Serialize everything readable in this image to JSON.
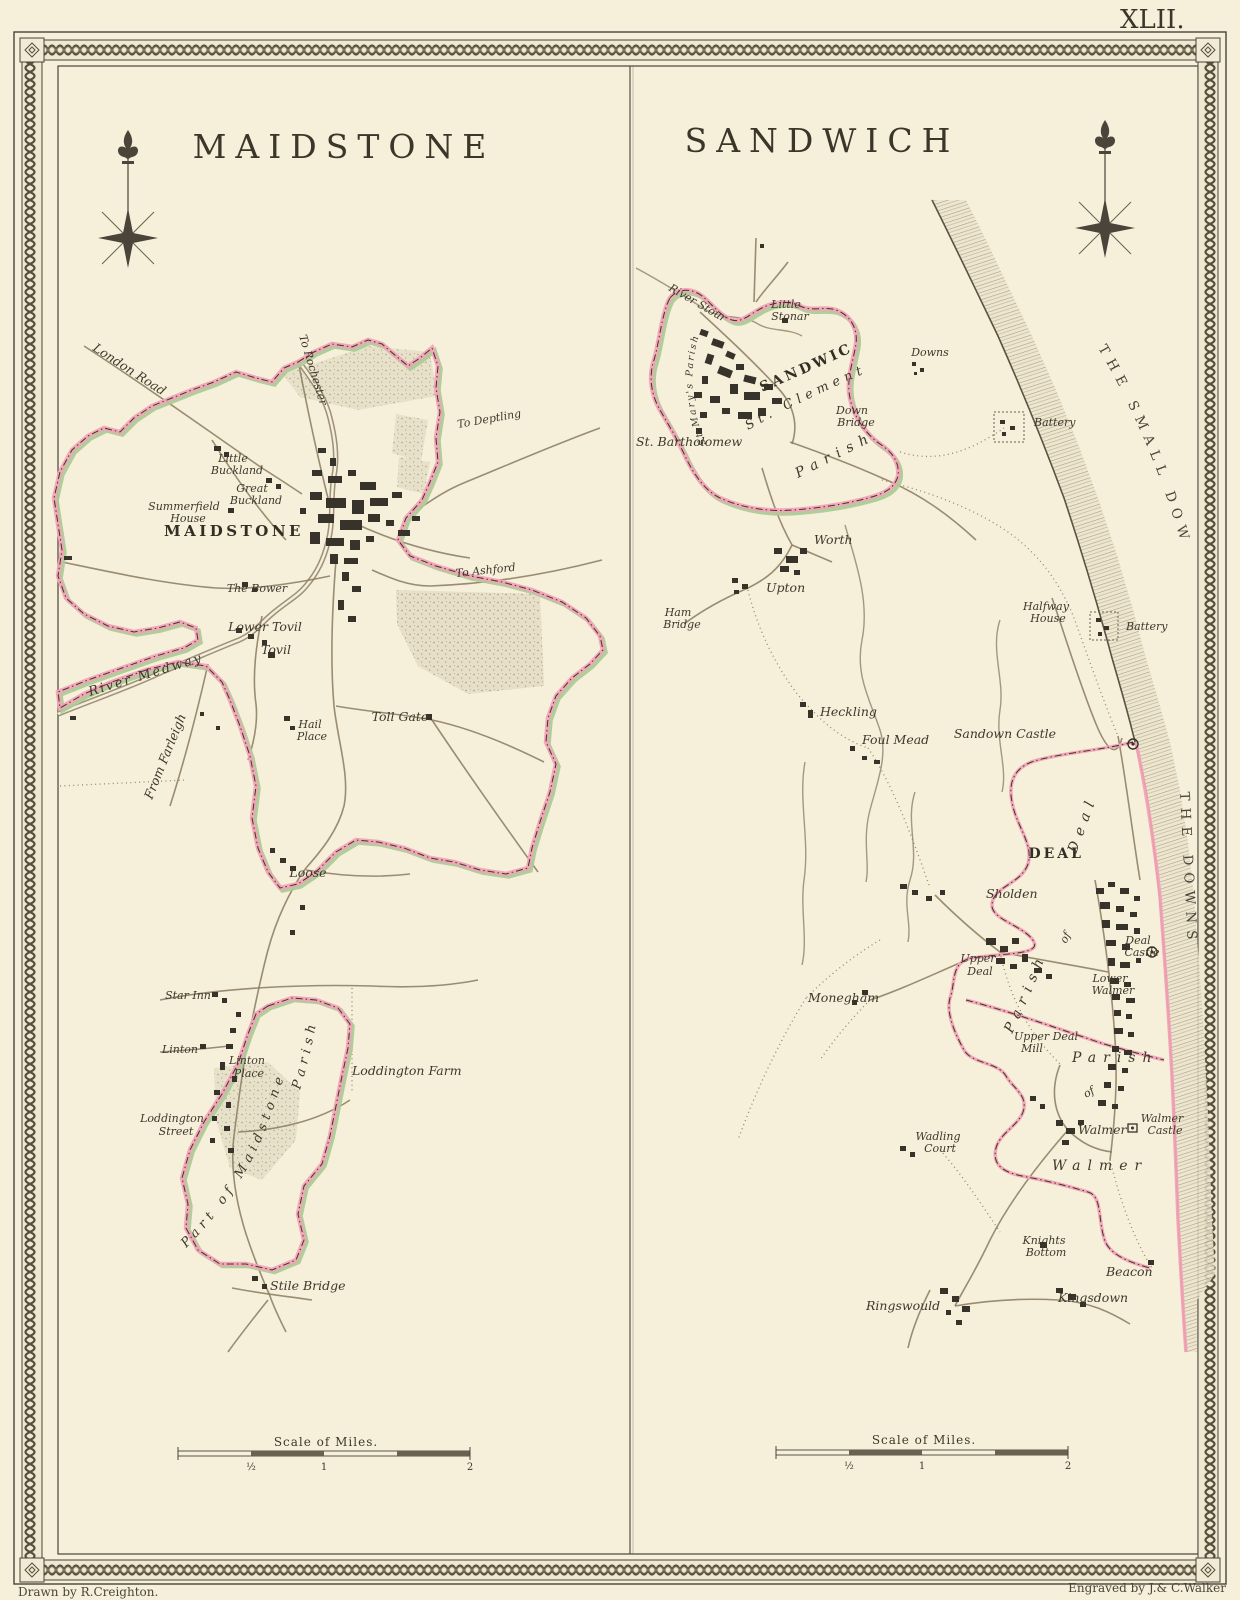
{
  "page": {
    "plate_number": "XLII.",
    "credit_left": "Drawn by R.Creighton.",
    "credit_right": "Engraved by J.& C.Walker",
    "colors": {
      "paper": "#f6efda",
      "ink": "#3e382c",
      "boundary_pink": "#f2a2b6",
      "boundary_green": "#accb96",
      "road_brown": "#8a7a5e"
    }
  },
  "maidstone": {
    "title": "MAIDSTONE",
    "scale_label": "Scale of Miles.",
    "scale_ticks": [
      "½",
      "1",
      "2"
    ],
    "labels": {
      "london_road": "London Road",
      "to_rochester": "To Rochester",
      "to_deptling": "To Deptling",
      "to_ashford": "To Ashford",
      "from_farleigh": "From Farleigh",
      "little_buckland_1": "Little",
      "little_buckland_2": "Buckland",
      "great_buckland_1": "Great",
      "great_buckland_2": "Buckland",
      "summerfield_1": "Summerfield",
      "summerfield_2": "House",
      "town": "MAIDSTONE",
      "the_bower": "The Bower",
      "lower_tovil": "Lower Tovil",
      "tovil": "Tovil",
      "river_medway": "River Medway",
      "hail_place_1": "Hail",
      "hail_place_2": "Place",
      "toll_gate": "Toll Gate",
      "loose": "Loose",
      "star_inn": "Star Inn",
      "linton": "Linton",
      "linton_place_1": "Linton",
      "linton_place_2": "Place",
      "loddington_street_1": "Loddington",
      "loddington_street_2": "Street",
      "loddington_farm": "Loddington Farm",
      "parish": "Parish",
      "part_of_maidstone": "Part of Maidstone",
      "stile_bridge": "Stile Bridge"
    }
  },
  "sandwich": {
    "title": "SANDWICH",
    "scale_label": "Scale of Miles.",
    "scale_ticks": [
      "½",
      "1",
      "2"
    ],
    "labels": {
      "river_stour": "River Stour",
      "little_stonar_1": "Little",
      "little_stonar_2": "Stonar",
      "town": "SANDWICH",
      "st_marys_parish": "St Mary's Parish",
      "st_clements": "St. Clements",
      "st_clements_parish": "Parish",
      "st_bartholomew": "St. Bartholomew",
      "downs": "Downs",
      "down_bridge_1": "Down",
      "down_bridge_2": "Bridge",
      "battery_north": "Battery",
      "battery_south": "Battery",
      "halfway_house_1": "Halfway",
      "halfway_house_2": "House",
      "sandown_castle": "Sandown Castle",
      "the_small_downs": "THE SMALL DOWNS",
      "the_downs": "THE DOWNS",
      "ham_bridge_1": "Ham",
      "ham_bridge_2": "Bridge",
      "upton": "Upton",
      "worth": "Worth",
      "heckling": "Heckling",
      "foul_mead": "Foul Mead",
      "sholden": "Sholden",
      "deal": "DEAL",
      "deal_parish_parish": "Parish",
      "deal_parish_of": "of",
      "deal_parish_deal": "Deal",
      "upper_deal_1": "Upper",
      "upper_deal_2": "Deal",
      "monegham": "Monegham",
      "lower_walmer_1": "Lower",
      "lower_walmer_2": "Walmer",
      "deal_castle_1": "Deal",
      "deal_castle_2": "Castle",
      "upper_deal_mill_1": "Upper Deal",
      "upper_deal_mill_2": "Mill",
      "walmer_parish": "Parish",
      "walmer_of": "of",
      "walmer_village": "Walmer",
      "walmer_castle_1": "Walmer",
      "walmer_castle_2": "Castle",
      "walmer_spread": "Walmer",
      "wadling_court_1": "Wadling",
      "wadling_court_2": "Court",
      "knights_bottom_1": "Knights",
      "knights_bottom_2": "Bottom",
      "beacon": "Beacon",
      "ringswould": "Ringswould",
      "kingsdown": "Kingsdown"
    }
  }
}
